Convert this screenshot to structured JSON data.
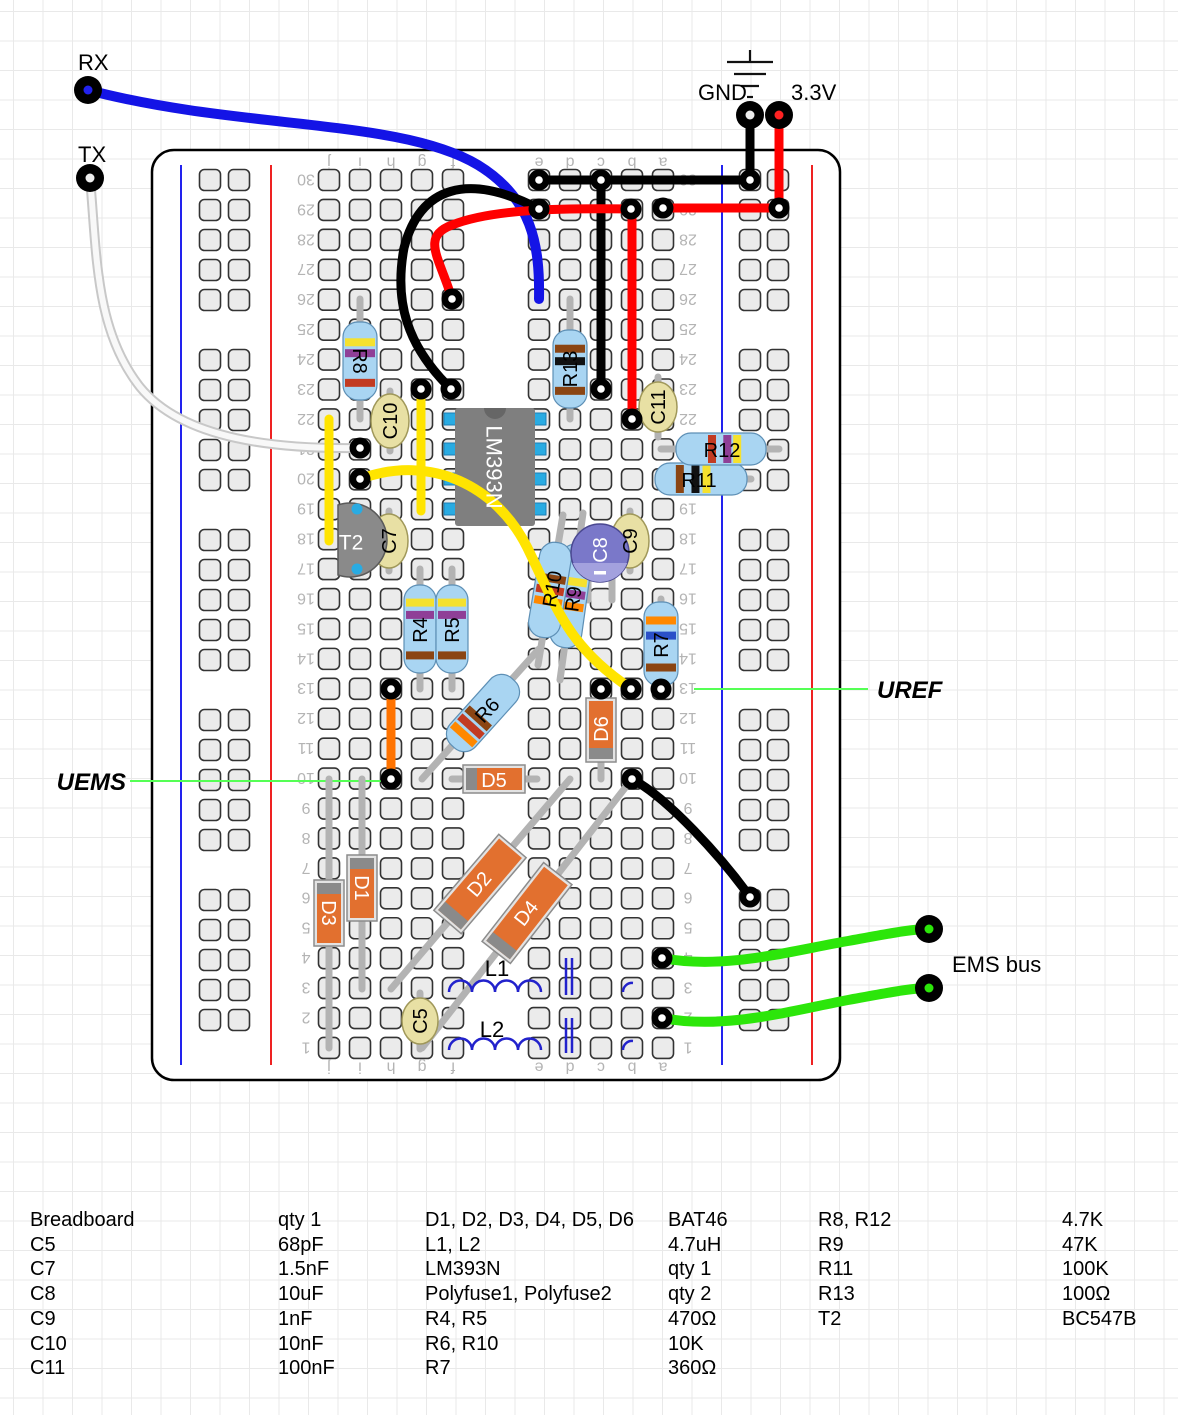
{
  "board": {
    "x": 152,
    "y": 150,
    "w": 688,
    "h": 930,
    "corner": 22,
    "fill": "#ffffff",
    "stroke": "#000000",
    "rows": 30,
    "row_y0": 180,
    "row_dy": 29.93,
    "cols": {
      "j": 329,
      "i": 360,
      "h": 391,
      "g": 422,
      "f": 453,
      "e": 539,
      "d": 570,
      "c": 601,
      "b": 632,
      "a": 663
    },
    "col_letters": [
      "j",
      "i",
      "h",
      "g",
      "f",
      "e",
      "d",
      "c",
      "b",
      "a"
    ],
    "letters_y_top": 163,
    "letters_y_bottom": 1068,
    "num_x_left": 306,
    "num_x_right": 688,
    "hole": {
      "size": 21,
      "rx": 5,
      "fill": "#ebebeb",
      "stroke": "#333333"
    },
    "rails": {
      "left": {
        "blue_x": 181,
        "red_x": 271,
        "hole_x": [
          210,
          239
        ]
      },
      "right": {
        "blue_x": 722,
        "red_x": 812,
        "hole_x": [
          750,
          778
        ]
      },
      "groups": 5,
      "group_rows": 5,
      "y0": 180,
      "dy": 30,
      "group_step": 180
    }
  },
  "ground_symbol": {
    "lines": [
      [
        727,
        62,
        773,
        62
      ],
      [
        734,
        74,
        766,
        74
      ],
      [
        741,
        86,
        759,
        86
      ],
      [
        747,
        97,
        753,
        97
      ],
      [
        750,
        50,
        750,
        62
      ]
    ]
  },
  "leads": [
    [
      360,
      299,
      360,
      419
    ],
    [
      570,
      299,
      570,
      419
    ],
    [
      420,
      569,
      420,
      689
    ],
    [
      452,
      569,
      452,
      689
    ],
    [
      661,
      599,
      661,
      689
    ],
    [
      422,
      779,
      539,
      649
    ],
    [
      583,
      513,
      560,
      680
    ],
    [
      563,
      515,
      538,
      665
    ],
    [
      661,
      479,
      751,
      479
    ],
    [
      661,
      449,
      779,
      449
    ],
    [
      362,
      779,
      362,
      989
    ],
    [
      329,
      779,
      329,
      1048
    ],
    [
      601,
      689,
      601,
      779
    ],
    [
      452,
      779,
      537,
      779
    ],
    [
      391,
      989,
      570,
      779
    ],
    [
      422,
      1048,
      632,
      779
    ],
    [
      390,
      391,
      390,
      451
    ],
    [
      389,
      511,
      389,
      571
    ],
    [
      630,
      511,
      630,
      571
    ],
    [
      658,
      377,
      658,
      437
    ],
    [
      420,
      993,
      420,
      1049
    ],
    [
      588,
      555,
      588,
      600
    ],
    [
      612,
      555,
      612,
      600
    ]
  ],
  "components": {
    "resistors": [
      {
        "name": "R8",
        "cx": 360,
        "cy": 361,
        "angle": 0,
        "L": 78,
        "W": 34,
        "bands": [
          [
            0.26,
            "#f5e12e"
          ],
          [
            0.4,
            "#8f3f97"
          ],
          [
            0.78,
            "#c23b22"
          ]
        ]
      },
      {
        "name": "R13",
        "cx": 570,
        "cy": 369,
        "angle": 0,
        "L": 78,
        "W": 34,
        "bands": [
          [
            0.24,
            "#8b4513"
          ],
          [
            0.4,
            "#111111"
          ],
          [
            0.78,
            "#8b4513"
          ]
        ]
      },
      {
        "name": "R4",
        "cx": 420,
        "cy": 629,
        "angle": 0,
        "L": 88,
        "W": 32,
        "bands": [
          [
            0.2,
            "#f5e12e"
          ],
          [
            0.34,
            "#8f3f97"
          ],
          [
            0.8,
            "#8b4513"
          ]
        ]
      },
      {
        "name": "R5",
        "cx": 452,
        "cy": 629,
        "angle": 0,
        "L": 88,
        "W": 32,
        "bands": [
          [
            0.2,
            "#f5e12e"
          ],
          [
            0.34,
            "#8f3f97"
          ],
          [
            0.8,
            "#8b4513"
          ]
        ]
      },
      {
        "name": "R7",
        "cx": 661,
        "cy": 644,
        "angle": 0,
        "L": 84,
        "W": 34,
        "bands": [
          [
            0.22,
            "#ff8800"
          ],
          [
            0.4,
            "#2b50c8"
          ],
          [
            0.78,
            "#8b4513"
          ]
        ]
      },
      {
        "name": "R6",
        "cx": 483,
        "cy": 713,
        "angle": 42,
        "L": 90,
        "W": 34,
        "bands": [
          [
            0.58,
            "#8b4513"
          ],
          [
            0.7,
            "#c23b22"
          ],
          [
            0.82,
            "#ff8800"
          ]
        ]
      },
      {
        "name": "R9",
        "cx": 571,
        "cy": 596,
        "angle": 8,
        "L": 104,
        "W": 32,
        "bands": [
          [
            0.36,
            "#f5e12e"
          ],
          [
            0.48,
            "#8f3f97"
          ],
          [
            0.6,
            "#ff8800"
          ]
        ]
      },
      {
        "name": "R10",
        "cx": 550,
        "cy": 590,
        "angle": 9.5,
        "L": 96,
        "W": 32,
        "bands": [
          [
            0.38,
            "#8b4513"
          ],
          [
            0.5,
            "#c23b22"
          ],
          [
            0.62,
            "#ff8800"
          ]
        ]
      },
      {
        "name": "R11",
        "cx": 701,
        "cy": 479,
        "angle": -90,
        "L": 92,
        "W": 32,
        "bands": [
          [
            0.27,
            "#8b4513"
          ],
          [
            0.44,
            "#111111"
          ],
          [
            0.56,
            "#f5e12e"
          ]
        ]
      },
      {
        "name": "R12",
        "cx": 721,
        "cy": 449,
        "angle": -90,
        "L": 90,
        "W": 32,
        "bands": [
          [
            0.4,
            "#c23b22"
          ],
          [
            0.57,
            "#8f3f97"
          ],
          [
            0.68,
            "#f5e12e"
          ]
        ]
      }
    ],
    "capacitors": [
      {
        "name": "C10",
        "cx": 390,
        "cy": 421,
        "rx": 19,
        "ry": 27
      },
      {
        "name": "C7",
        "cx": 389,
        "cy": 541,
        "rx": 19,
        "ry": 27
      },
      {
        "name": "C9",
        "cx": 630,
        "cy": 541,
        "rx": 19,
        "ry": 27
      },
      {
        "name": "C11",
        "cx": 658,
        "cy": 407,
        "rx": 19,
        "ry": 25
      },
      {
        "name": "C5",
        "cx": 420,
        "cy": 1021,
        "rx": 18,
        "ry": 23
      }
    ],
    "electrolytic": {
      "name": "C8",
      "cx": 600,
      "cy": 553,
      "r": 29,
      "fill": "#7a78c9",
      "slice": "#a3a1de",
      "stroke": "#4a4890"
    },
    "diodes": [
      {
        "name": "D1",
        "cx": 362,
        "cy": 888,
        "angle": 0,
        "L": 66,
        "W": 30,
        "cap": "top"
      },
      {
        "name": "D3",
        "cx": 329,
        "cy": 913,
        "angle": 0,
        "L": 66,
        "W": 30,
        "cap": "top"
      },
      {
        "name": "D6",
        "cx": 601,
        "cy": 730,
        "angle": 0,
        "L": 64,
        "W": 30,
        "cap": "bottom"
      },
      {
        "name": "D5",
        "cx": 494,
        "cy": 779,
        "angle": -90,
        "L": 62,
        "W": 28,
        "cap": "top"
      },
      {
        "name": "D2",
        "cx": 480,
        "cy": 884,
        "angle": 40.5,
        "L": 100,
        "W": 36,
        "cap": "bottom"
      },
      {
        "name": "D4",
        "cx": 527,
        "cy": 913,
        "angle": 38,
        "L": 100,
        "W": 36,
        "cap": "bottom"
      }
    ],
    "ic": {
      "name": "LM393N",
      "x": 455,
      "y": 408,
      "w": 80,
      "h": 118,
      "fill": "#7f7f7f",
      "pin_fill": "#29abe2",
      "pin_y": [
        419,
        449,
        479,
        509
      ]
    },
    "transistor": {
      "name": "T2",
      "path": "M 338,505 A 37 37 0 1 1 338,575 Z",
      "fill": "#8a8a8a",
      "stroke": "#5a5a5a",
      "dots": [
        [
          357,
          509
        ],
        [
          357,
          569
        ]
      ],
      "dot_fill": "#29abe2"
    },
    "inductors": [
      {
        "name": "L1",
        "x1": 449,
        "y": 992,
        "bumps": 4,
        "r": 11.5,
        "tail_x": 623
      },
      {
        "name": "L2",
        "x1": 449,
        "y": 1050,
        "bumps": 4,
        "r": 11.5,
        "tail_x": 623
      }
    ],
    "polyfuse_marks": [
      {
        "x": [
          566,
          572
        ],
        "y1": 958,
        "y2": 995
      },
      {
        "x": [
          566,
          572
        ],
        "y1": 1018,
        "y2": 1053
      }
    ]
  },
  "wires": [
    {
      "name": "blue-rx",
      "color": "#1414e6",
      "w": 10,
      "d": "M 88,90 C 240,130 400,118 478,165 C 532,198 540,245 539,299"
    },
    {
      "name": "white-tx",
      "color": "white",
      "w": 7,
      "d": "M 90,178 C 97,255 95,330 140,387 C 184,441 280,449 358,448"
    },
    {
      "name": "black-row30",
      "color": "#000000",
      "w": 9,
      "d": "M 539,180 L 750,180"
    },
    {
      "name": "black-gnd",
      "color": "#000000",
      "w": 9,
      "d": "M 750,115 L 750,180"
    },
    {
      "name": "black-arc",
      "color": "#000000",
      "w": 9,
      "d": "M 539,209 C 468,172 420,186 404,248 C 394,302 407,346 451,389"
    },
    {
      "name": "black-col-c",
      "color": "#000000",
      "w": 9,
      "d": "M 601,180 L 601,389"
    },
    {
      "name": "black-diagonal",
      "color": "#000000",
      "w": 9,
      "d": "M 632,779 C 668,798 722,858 750,897"
    },
    {
      "name": "red-3v3",
      "color": "#ff0000",
      "w": 9,
      "d": "M 779,115 L 779,208"
    },
    {
      "name": "red-row29",
      "color": "#ff0000",
      "w": 9,
      "d": "M 663,208 L 779,208"
    },
    {
      "name": "red-arc",
      "color": "#ff0000",
      "w": 9,
      "d": "M 452,299 C 440,258 420,237 452,225 C 492,209 560,208 631,209"
    },
    {
      "name": "red-col-b",
      "color": "#ff0000",
      "w": 9,
      "d": "M 632,209 L 632,419"
    },
    {
      "name": "yellow-col-j",
      "color": "#ffe400",
      "w": 9,
      "d": "M 329,419 L 329,541"
    },
    {
      "name": "yellow-col-g",
      "color": "#ffe400",
      "w": 9,
      "d": "M 421,389 L 421,511"
    },
    {
      "name": "yellow-arc",
      "color": "#ffe400",
      "w": 10,
      "d": "M 360,479 C 432,453 497,487 527,547 C 556,606 567,646 630,688"
    },
    {
      "name": "orange-col-h",
      "color": "#ff7300",
      "w": 9,
      "d": "M 391,689 L 391,779"
    },
    {
      "name": "green-ems-1",
      "color": "#2ce60a",
      "w": 10,
      "d": "M 662,958 C 724,970 790,951 848,941 C 892,933 912,929 929,929"
    },
    {
      "name": "green-ems-2",
      "color": "#2ce60a",
      "w": 10,
      "d": "M 662,1018 C 724,1030 790,1011 848,1000 C 892,992 912,988 929,988"
    }
  ],
  "annotation_lines": [
    {
      "name": "uems-line",
      "color": "#55ff55",
      "w": 2,
      "d": "M 130,781 L 391,781"
    },
    {
      "name": "uref-line",
      "color": "#55ff55",
      "w": 2,
      "d": "M 694,689 L 868,689"
    }
  ],
  "rings": [
    [
      539,
      180
    ],
    [
      750,
      180
    ],
    [
      539,
      209
    ],
    [
      451,
      389
    ],
    [
      601,
      180
    ],
    [
      601,
      389
    ],
    [
      452,
      299
    ],
    [
      631,
      209
    ],
    [
      663,
      208
    ],
    [
      779,
      208
    ],
    [
      632,
      419
    ],
    [
      360,
      448
    ],
    [
      360,
      479
    ],
    [
      421,
      389
    ],
    [
      631,
      689
    ],
    [
      601,
      689
    ],
    [
      661,
      689
    ],
    [
      391,
      689
    ],
    [
      391,
      779
    ],
    [
      632,
      779
    ],
    [
      750,
      897
    ],
    [
      662,
      958
    ],
    [
      662,
      1018
    ]
  ],
  "pins": [
    {
      "name": "rx-pin",
      "x": 88,
      "y": 90,
      "center": "#2222ee"
    },
    {
      "name": "tx-pin",
      "x": 90,
      "y": 178,
      "center": "#eeeeee"
    },
    {
      "name": "gnd-pin",
      "x": 750,
      "y": 115,
      "center": "#eeeeee"
    },
    {
      "name": "v33-pin",
      "x": 779,
      "y": 115,
      "center": "#ff2222"
    },
    {
      "name": "ems-pin-1",
      "x": 929,
      "y": 929,
      "center": "#2ce60a"
    },
    {
      "name": "ems-pin-2",
      "x": 929,
      "y": 988,
      "center": "#2ce60a"
    }
  ],
  "labels": [
    {
      "id": "label-R8",
      "text": "R8",
      "x": 360,
      "y": 361,
      "rot": 90
    },
    {
      "id": "label-R13",
      "text": "R13",
      "x": 570,
      "y": 369,
      "rot": -90
    },
    {
      "id": "label-R4",
      "text": "R4",
      "x": 420,
      "y": 630,
      "rot": -90
    },
    {
      "id": "label-R5",
      "text": "R5",
      "x": 452,
      "y": 630,
      "rot": -90
    },
    {
      "id": "label-R7",
      "text": "R7",
      "x": 661,
      "y": 645,
      "rot": -90
    },
    {
      "id": "label-R6",
      "text": "R6",
      "x": 487,
      "y": 710,
      "rot": -48
    },
    {
      "id": "label-R9",
      "text": "R9",
      "x": 573,
      "y": 599,
      "rot": -82
    },
    {
      "id": "label-R10",
      "text": "R10",
      "x": 552,
      "y": 589,
      "rot": -80
    },
    {
      "id": "label-R11",
      "text": "R11",
      "x": 699,
      "y": 480,
      "rot": 0
    },
    {
      "id": "label-R12",
      "text": "R12",
      "x": 722,
      "y": 450,
      "rot": 0
    },
    {
      "id": "label-C10",
      "text": "C10",
      "x": 390,
      "y": 421,
      "rot": -90
    },
    {
      "id": "label-C7",
      "text": "C7",
      "x": 389,
      "y": 541,
      "rot": -90
    },
    {
      "id": "label-C9",
      "text": "C9",
      "x": 630,
      "y": 541,
      "rot": -90
    },
    {
      "id": "label-C11",
      "text": "C11",
      "x": 658,
      "y": 407,
      "rot": -90
    },
    {
      "id": "label-C5",
      "text": "C5",
      "x": 420,
      "y": 1021,
      "rot": -90
    },
    {
      "id": "label-C8",
      "text": "C8",
      "x": 600,
      "y": 550,
      "rot": -90,
      "fill": "#ffffff"
    },
    {
      "id": "label-D1",
      "text": "D1",
      "x": 362,
      "y": 888,
      "rot": 90,
      "fill": "#ffffff"
    },
    {
      "id": "label-D3",
      "text": "D3",
      "x": 329,
      "y": 913,
      "rot": 90,
      "fill": "#ffffff"
    },
    {
      "id": "label-D6",
      "text": "D6",
      "x": 601,
      "y": 729,
      "rot": -90,
      "fill": "#ffffff"
    },
    {
      "id": "label-D5",
      "text": "D5",
      "x": 494,
      "y": 780,
      "rot": 0,
      "fill": "#ffffff"
    },
    {
      "id": "label-D2",
      "text": "D2",
      "x": 479,
      "y": 884,
      "rot": -50,
      "fill": "#ffffff"
    },
    {
      "id": "label-D4",
      "text": "D4",
      "x": 526,
      "y": 913,
      "rot": -52,
      "fill": "#ffffff"
    },
    {
      "id": "label-LM393N",
      "text": "LM393N",
      "x": 494,
      "y": 467,
      "rot": 90,
      "fill": "#ffffff",
      "size": 22
    },
    {
      "id": "label-T2",
      "text": "T2",
      "x": 351,
      "y": 542,
      "rot": 0,
      "fill": "#ffffff",
      "size": 21
    },
    {
      "id": "label-L1",
      "text": "L1",
      "x": 497,
      "y": 976,
      "rot": 0,
      "size": 22,
      "dy": "0",
      "anchor": "middle"
    },
    {
      "id": "label-L2",
      "text": "L2",
      "x": 492,
      "y": 1037,
      "rot": 0,
      "size": 22,
      "dy": "0",
      "anchor": "middle"
    },
    {
      "id": "label-RX",
      "text": "RX",
      "x": 78,
      "y": 70,
      "anchor": "start",
      "dy": "0",
      "size": 22
    },
    {
      "id": "label-TX",
      "text": "TX",
      "x": 78,
      "y": 162,
      "anchor": "start",
      "dy": "0",
      "size": 22
    },
    {
      "id": "label-GND",
      "text": "GND",
      "x": 698,
      "y": 100,
      "anchor": "start",
      "dy": "0",
      "size": 22
    },
    {
      "id": "label-3V3",
      "text": "3.3V",
      "x": 791,
      "y": 100,
      "anchor": "start",
      "dy": "0",
      "size": 22
    },
    {
      "id": "label-EMS-bus",
      "text": "EMS bus",
      "x": 952,
      "y": 972,
      "anchor": "start",
      "dy": "0",
      "size": 22
    },
    {
      "id": "label-UEMS",
      "text": "UEMS",
      "x": 126,
      "y": 790,
      "anchor": "end",
      "dy": "0",
      "size": 24,
      "bold": true,
      "italic": true
    },
    {
      "id": "label-UREF",
      "text": "UREF",
      "x": 877,
      "y": 698,
      "anchor": "start",
      "dy": "0",
      "size": 24,
      "bold": true,
      "italic": true
    }
  ],
  "parts_table": {
    "top": 1208,
    "columns": [
      {
        "x": 30,
        "lines": [
          "Breadboard",
          "C5",
          "C7",
          "C8",
          "C9",
          "C10",
          "C11"
        ]
      },
      {
        "x": 278,
        "lines": [
          "qty 1",
          "68pF",
          "1.5nF",
          "10uF",
          "1nF",
          "10nF",
          "100nF"
        ]
      },
      {
        "x": 425,
        "lines": [
          "D1, D2, D3, D4, D5, D6",
          "L1, L2",
          "LM393N",
          "Polyfuse1, Polyfuse2",
          "R4, R5",
          "R6, R10",
          "R7"
        ]
      },
      {
        "x": 668,
        "lines": [
          "BAT46",
          "4.7uH",
          "qty 1",
          "qty 2",
          "470Ω",
          "10K",
          "360Ω"
        ]
      },
      {
        "x": 818,
        "lines": [
          "R8, R12",
          "R9",
          "R11",
          "R13",
          "T2"
        ]
      },
      {
        "x": 1062,
        "lines": [
          "4.7K",
          "47K",
          "100K",
          "100Ω",
          "BC547B"
        ]
      }
    ]
  }
}
